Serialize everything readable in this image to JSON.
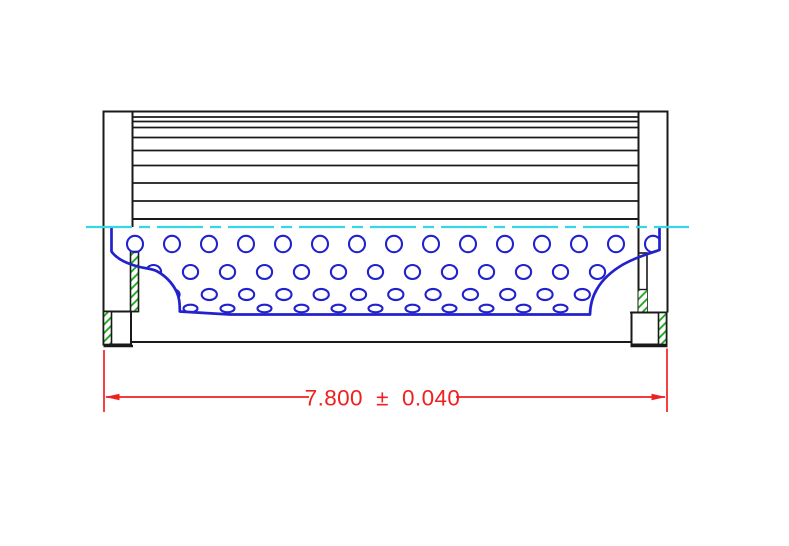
{
  "drawing": {
    "kind": "filter-element-cross-section",
    "dimension": {
      "label": "7.800 ± 0.040",
      "value": "7.800",
      "plus_minus": "±",
      "tolerance": "0.040"
    }
  },
  "colors": {
    "outline": "#1a1a1a",
    "core_blue": "#2121ce",
    "hatch_green": "#16a616",
    "centerline_cyan": "#35d6e8",
    "dimension_red": "#ef2020",
    "background": "#ffffff"
  },
  "geometry": {
    "canvas": {
      "width": 789,
      "height": 546
    },
    "pleat_block": {
      "x1": 132.5,
      "x2": 638.5,
      "top": 111.5,
      "bottom": 219,
      "inner_line_ys": [
        117,
        121.5,
        127.5,
        137.5,
        150.5,
        165.5,
        183,
        201
      ]
    },
    "perforations": {
      "rows": [
        {
          "cy": 244,
          "rx": 8,
          "ry": 8.2,
          "x_start": 135,
          "x_step": 37,
          "count": 15
        },
        {
          "cy": 272,
          "rx": 7.6,
          "ry": 7,
          "x_start": 153.5,
          "x_step": 37,
          "count": 13
        },
        {
          "cy": 294.5,
          "rx": 7.6,
          "ry": 5.6,
          "x_start": 172,
          "x_step": 37.3,
          "count": 12
        },
        {
          "cy": 308.5,
          "rx": 7,
          "ry": 3.8,
          "x_start": 190.5,
          "x_step": 37,
          "count": 11
        }
      ]
    },
    "centerline": {
      "y": 227,
      "x1": 86,
      "x2": 689
    }
  }
}
